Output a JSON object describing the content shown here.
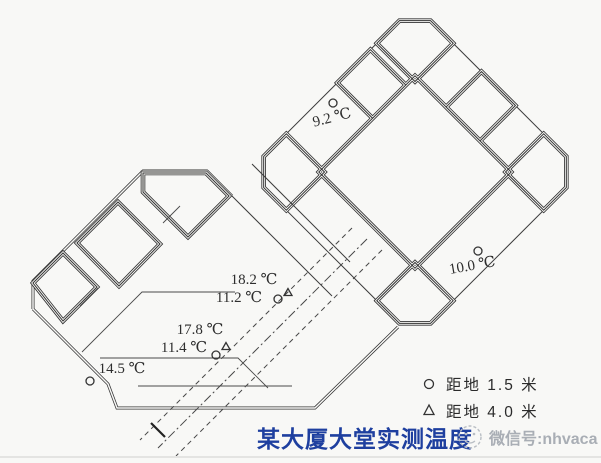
{
  "plan": {
    "caption": "某大厦大堂实测温度",
    "watermark": {
      "text": "微信号:nhvaca"
    },
    "legend": {
      "items": [
        {
          "symbol": "circle-marker",
          "label": "距地  1.5  米"
        },
        {
          "symbol": "triangle-marker",
          "label": "距地  4.0  米"
        }
      ]
    },
    "measurements": [
      {
        "label": "9.2 ℃",
        "marker": "circle",
        "location": "tower-upper-left-gallery"
      },
      {
        "label": "18.2 ℃",
        "marker": "triangle",
        "location": "lobby-upper"
      },
      {
        "label": "11.2 ℃",
        "marker": "circle",
        "location": "lobby-upper"
      },
      {
        "label": "17.8 ℃",
        "marker": "triangle",
        "location": "lobby-middle"
      },
      {
        "label": "11.4 ℃",
        "marker": "circle-triangle",
        "location": "lobby-middle"
      },
      {
        "label": "14.5 ℃",
        "marker": "circle",
        "location": "lobby-lower-left"
      },
      {
        "label": "10.0 ℃",
        "marker": "circle",
        "location": "tower-lower-right-gallery"
      }
    ],
    "colors": {
      "caption_blue": "#1e3f9f",
      "line_dark": "#333333",
      "watermark_gray": "#a9aeb5",
      "background": "#f8f8f6"
    }
  }
}
